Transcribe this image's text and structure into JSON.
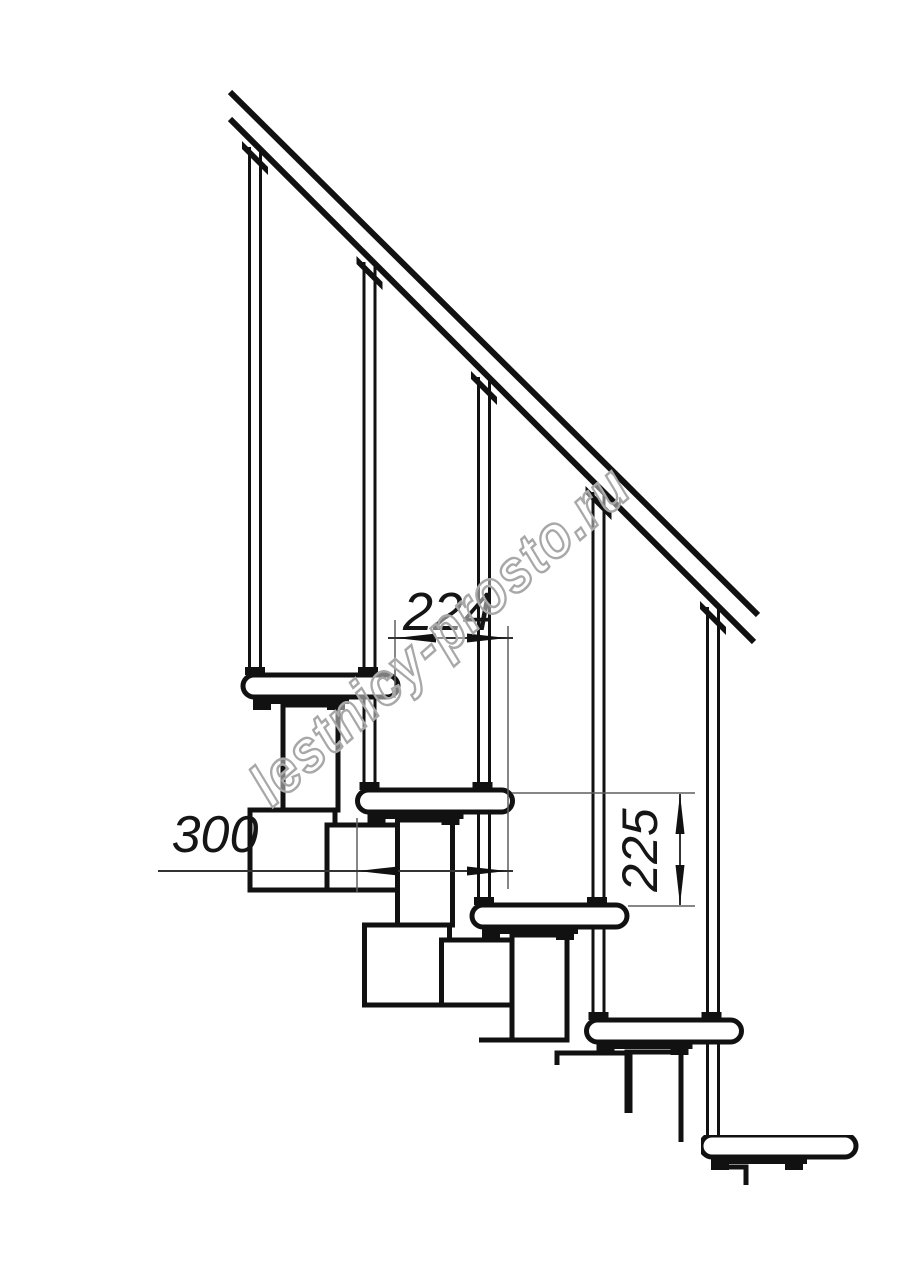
{
  "page": {
    "background": "#ffffff"
  },
  "drawing": {
    "subject": "Modular staircase side-view fragment, technical line drawing",
    "stroke_color": "#111111",
    "thin_line_color": "#5f5f5f",
    "dimensions": {
      "step_run": {
        "label": "224",
        "orientation": "horizontal"
      },
      "tread_depth": {
        "label": "300",
        "orientation": "horizontal"
      },
      "step_rise": {
        "label": "225",
        "orientation": "vertical"
      }
    },
    "watermark": {
      "text": "lestnicy-prosto.ru",
      "color": "#a8a8a8"
    }
  }
}
